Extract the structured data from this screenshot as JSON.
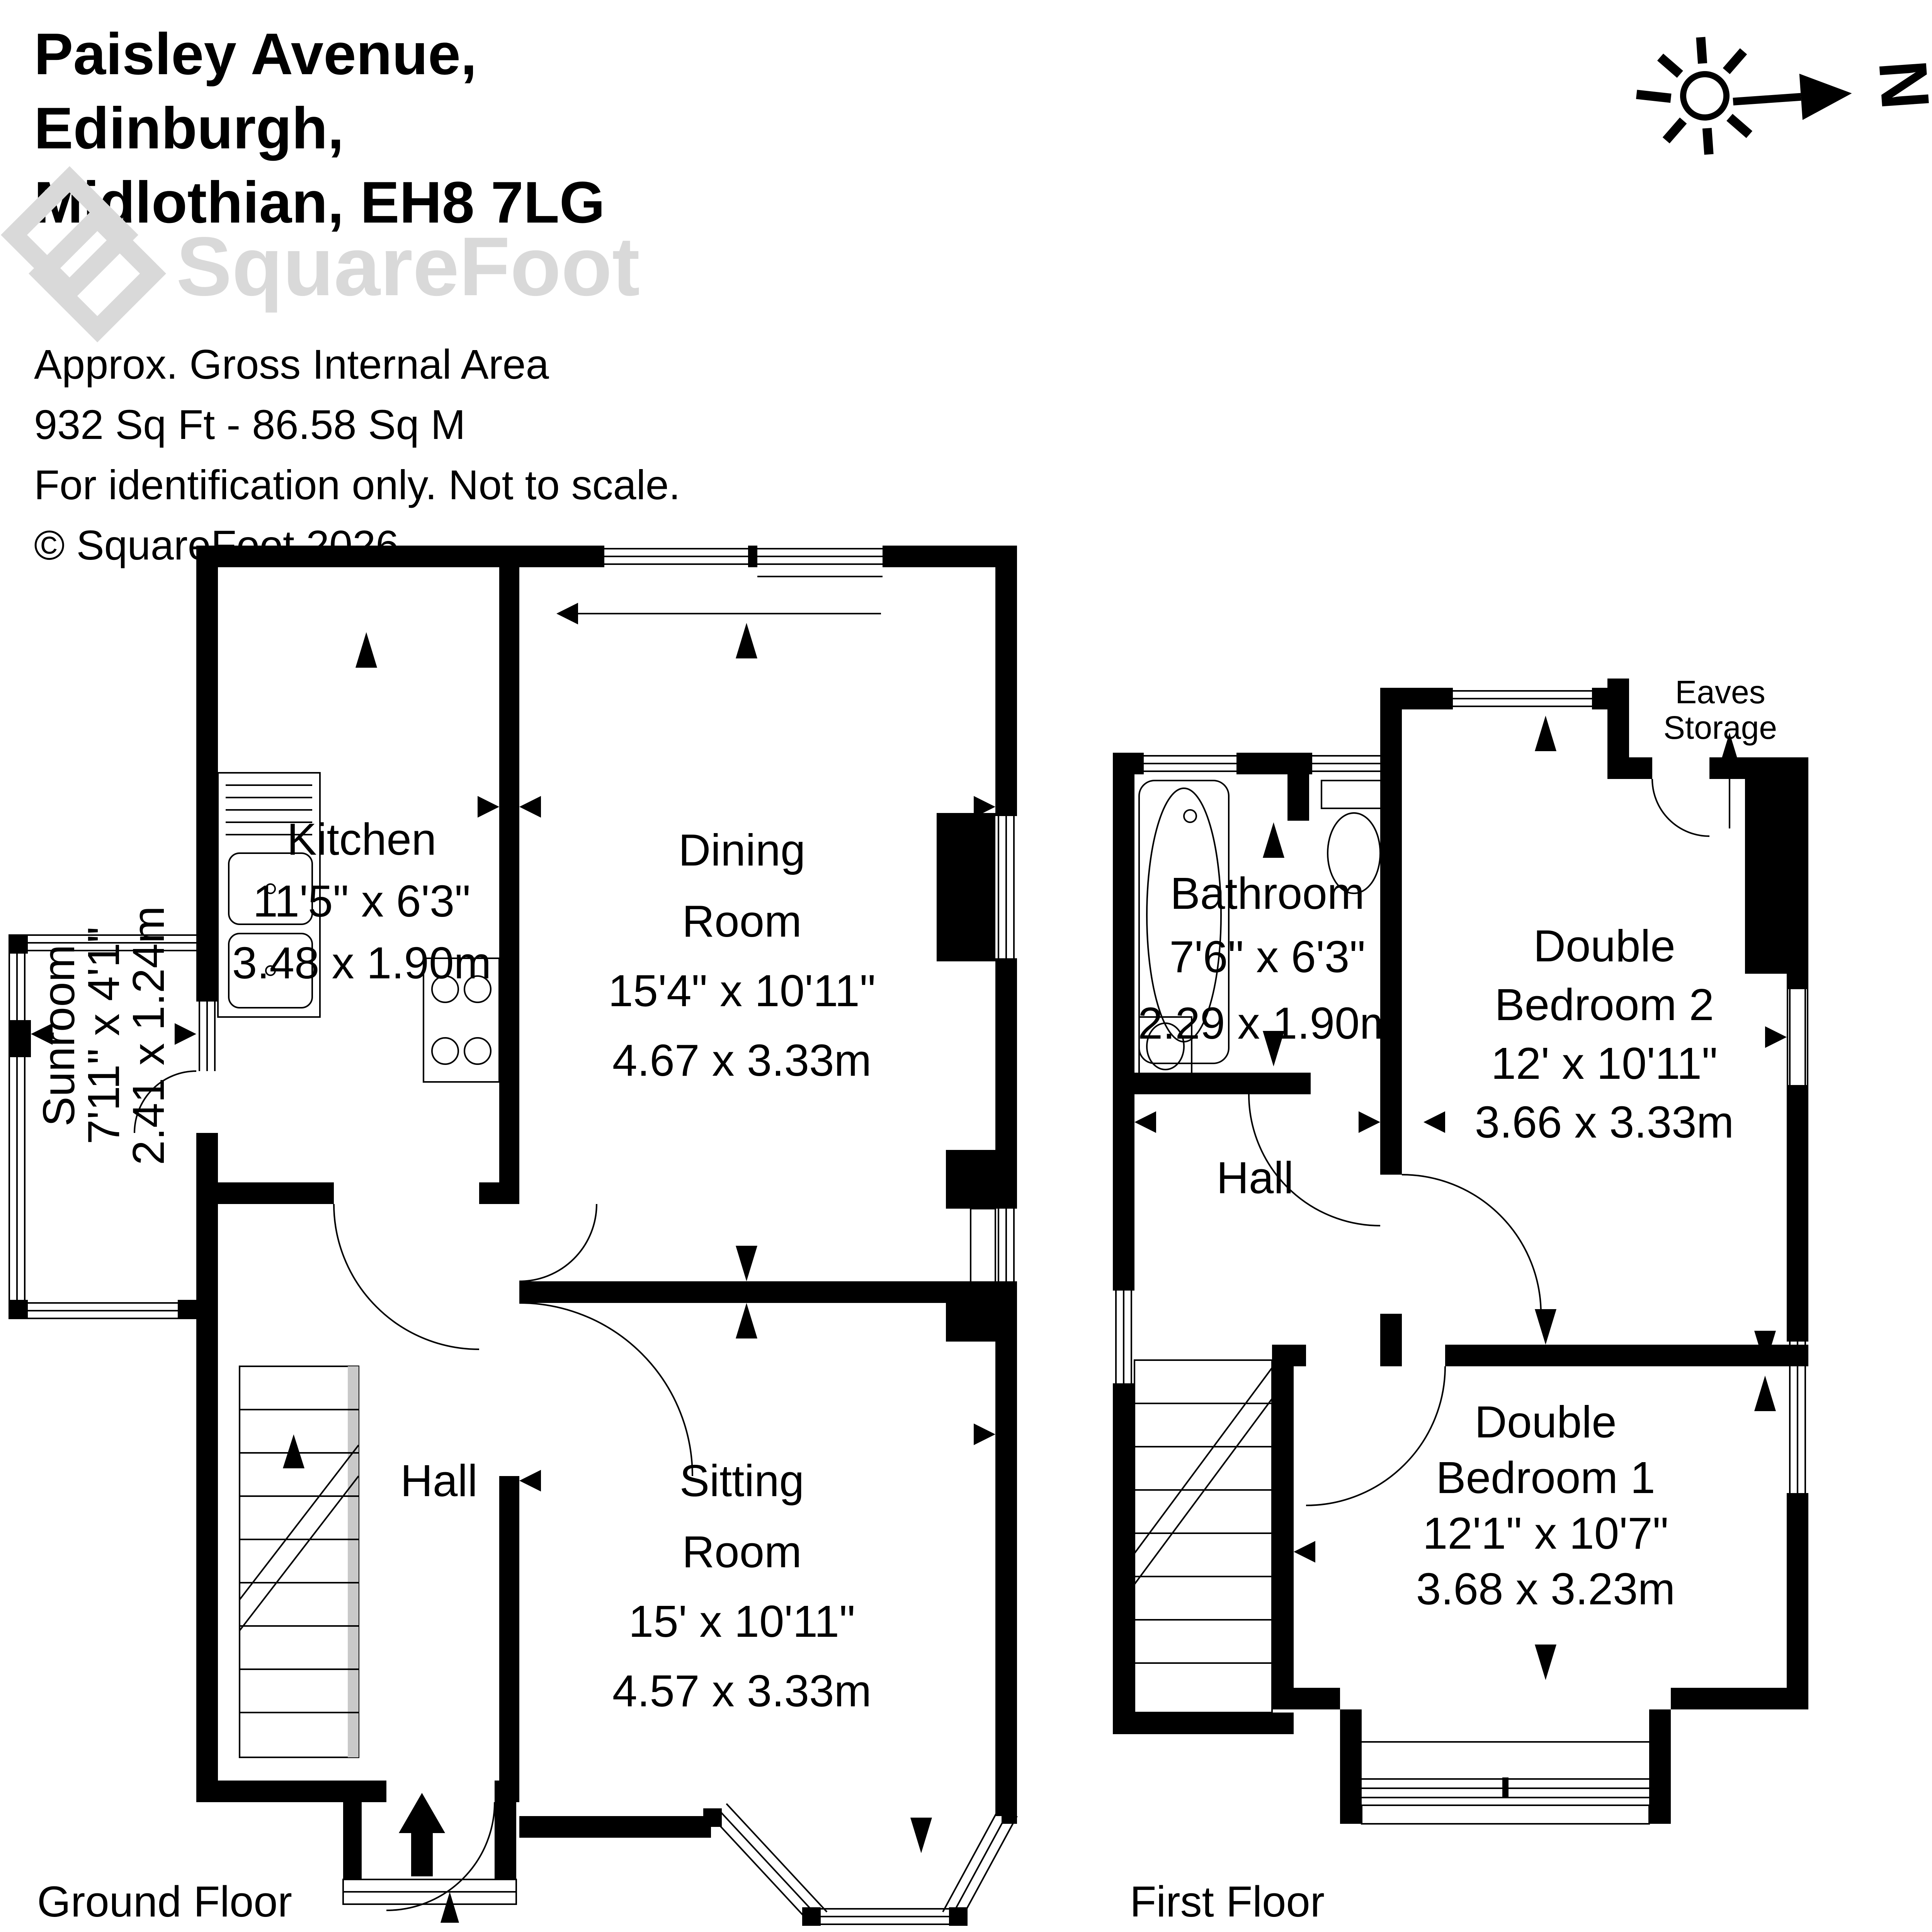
{
  "header": {
    "address_line1": "Paisley Avenue,",
    "address_line2": "Edinburgh,",
    "address_line3": "Midlothian, EH8 7LG"
  },
  "logo": {
    "brand": "SquareFoot"
  },
  "meta": {
    "line1": "Approx. Gross Internal Area",
    "line2": "932 Sq Ft  -  86.58 Sq M",
    "line3": "For identification only. Not to scale.",
    "line4": "© SquareFoot 2026"
  },
  "compass": {
    "north": "N"
  },
  "floors": {
    "ground": {
      "label": "Ground Floor",
      "kitchen": {
        "name": "Kitchen",
        "imperial": "11'5\" x 6'3\"",
        "metric": "3.48 x 1.90m"
      },
      "dining": {
        "name1": "Dining",
        "name2": "Room",
        "imperial": "15'4\" x 10'11\"",
        "metric": "4.67 x 3.33m"
      },
      "sunroom": {
        "name": "Sunroom",
        "imperial": "7'11\" x 4'1\"",
        "metric": "2.41 x 1.24m"
      },
      "hall": {
        "name": "Hall"
      },
      "sitting": {
        "name1": "Sitting",
        "name2": "Room",
        "imperial": "15' x 10'11\"",
        "metric": "4.57 x 3.33m"
      }
    },
    "first": {
      "label": "First Floor",
      "bathroom": {
        "name": "Bathroom",
        "imperial": "7'6\" x 6'3\"",
        "metric": "2.29 x 1.90m"
      },
      "bedroom2": {
        "name1": "Double",
        "name2": "Bedroom 2",
        "imperial": "12' x 10'11\"",
        "metric": "3.66 x 3.33m"
      },
      "hall": {
        "name": "Hall"
      },
      "bedroom1": {
        "name1": "Double",
        "name2": "Bedroom 1",
        "imperial": "12'1\" x 10'7\"",
        "metric": "3.68 x 3.23m"
      },
      "eaves": {
        "name1": "Eaves",
        "name2": "Storage"
      }
    }
  },
  "colors": {
    "wall": "#000000",
    "logo_gray": "#d9d9d9",
    "background": "#ffffff"
  }
}
